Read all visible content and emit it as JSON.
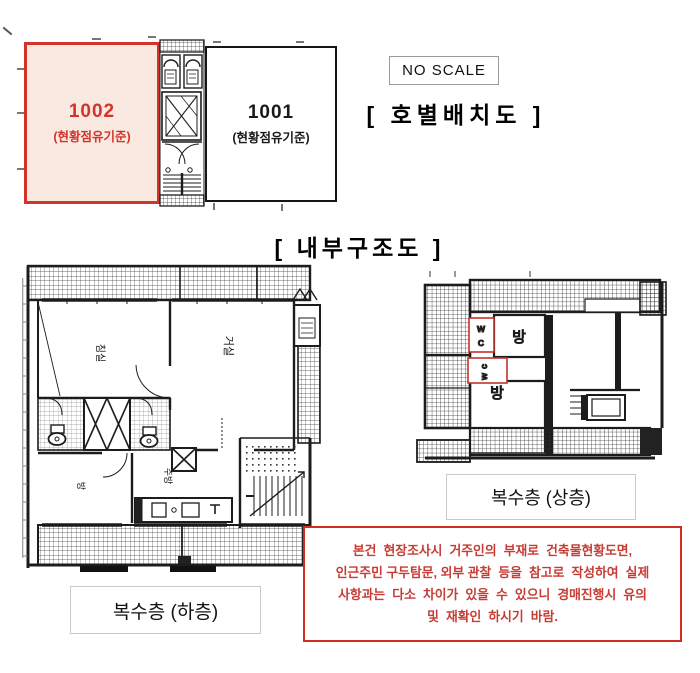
{
  "unit_layout": {
    "title": "[ 호별배치도 ]",
    "no_scale_label": "NO SCALE",
    "unit_1002": {
      "number": "1002",
      "caption": "(현황점유기준)"
    },
    "unit_1001": {
      "number": "1001",
      "caption": "(현황점유기준)"
    }
  },
  "internal_structure": {
    "title": "[ 내부구조도 ]",
    "lower_plan": {
      "label": "복수층 (하층)",
      "rooms": {
        "bedroom": "침실",
        "living": "거실",
        "small_room": "방",
        "kitchen": "주방"
      }
    },
    "upper_plan": {
      "label": "복수층 (상층)",
      "room_top": "방",
      "room_bottom": "방",
      "wc_top_line1": "W",
      "wc_top_line2": "C",
      "wc_side": "wc"
    }
  },
  "disclaimer": {
    "line1": "본건  현장조사시  거주인의  부재로  건축물현황도면,",
    "line2": "인근주민 구두탐문, 외부 관찰  등을  참고로  작성하여  실제",
    "line3": "사항과는  다소  차이가  있을  수  있으니  경매진행시  유의",
    "line4": "및  재확인  하시기  바람."
  },
  "colors": {
    "red_accent": "#cf2e26",
    "unit_fill": "#f9e9e0",
    "plan_ink": "#1c1c1c"
  }
}
